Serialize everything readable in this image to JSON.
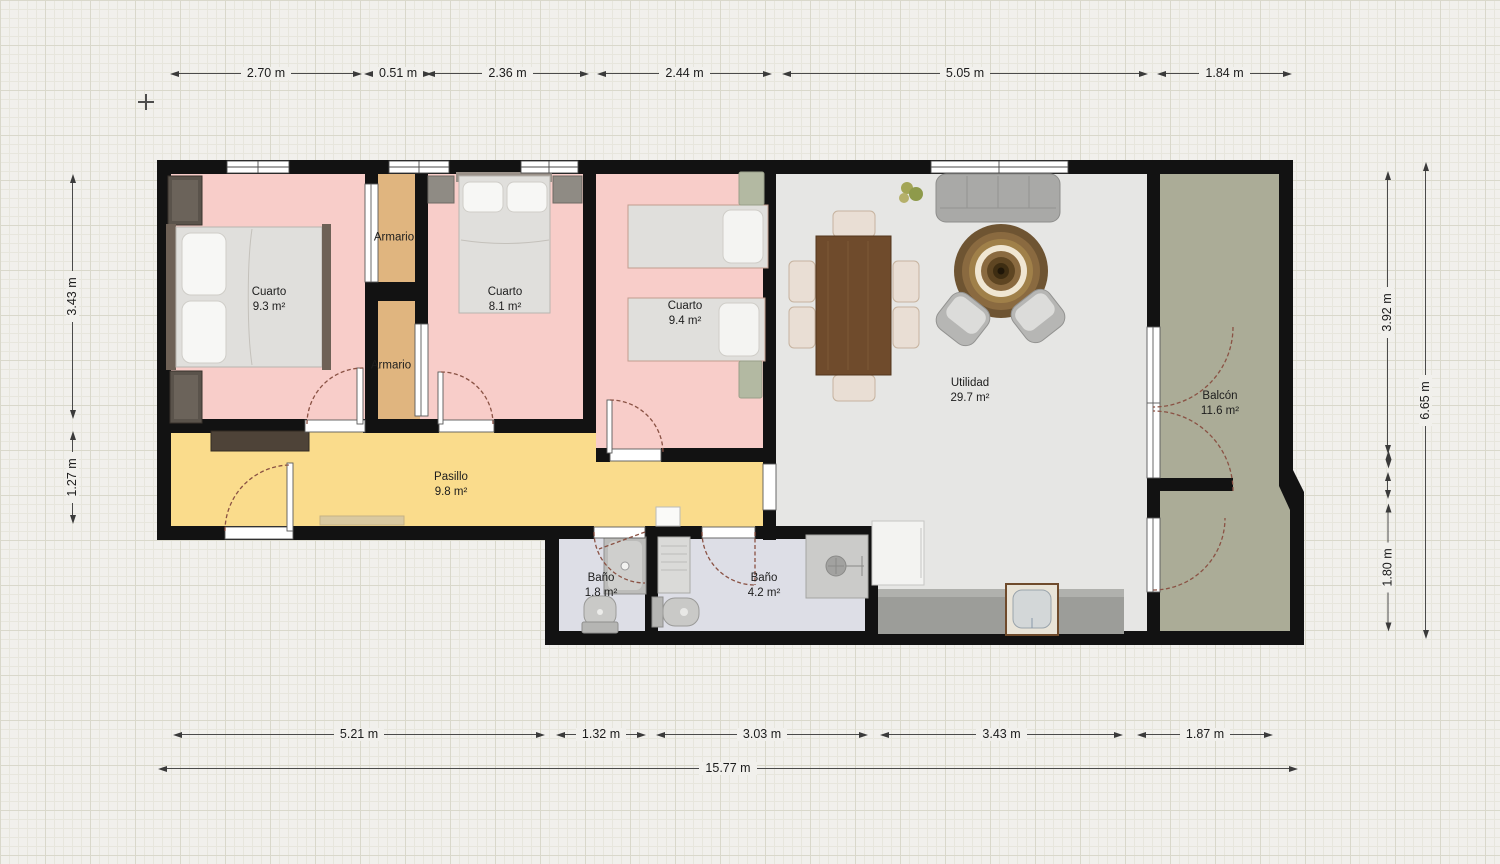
{
  "rooms": {
    "cuarto1": {
      "name": "Cuarto",
      "area": "9.3 m²",
      "color": "#f8cdc9"
    },
    "cuarto2": {
      "name": "Cuarto",
      "area": "8.1 m²",
      "color": "#f8cdc9"
    },
    "cuarto3": {
      "name": "Cuarto",
      "area": "9.4 m²",
      "color": "#f8cdc9"
    },
    "armario1": {
      "name": "Armario",
      "color": "#e0b57f"
    },
    "armario2": {
      "name": "Armario",
      "color": "#e0b57f"
    },
    "pasillo": {
      "name": "Pasillo",
      "area": "9.8 m²",
      "color": "#fadc8c"
    },
    "bano1": {
      "name": "Baño",
      "area": "1.8 m²",
      "color": "#dddee6"
    },
    "bano2": {
      "name": "Baño",
      "area": "4.2 m²",
      "color": "#dddee6"
    },
    "utilidad": {
      "name": "Utilidad",
      "area": "29.7 m²",
      "color": "#e6e6e4"
    },
    "balcon": {
      "name": "Balcón",
      "area": "11.6 m²",
      "color": "#abac97"
    }
  },
  "dimensions": {
    "top": [
      "2.70 m",
      "0.51 m",
      "2.36 m",
      "2.44 m",
      "5.05 m",
      "1.84 m"
    ],
    "left": [
      "3.43 m",
      "1.27 m"
    ],
    "right": [
      "3.92 m",
      "1.80 m"
    ],
    "right_overall": "6.65 m",
    "bottom": [
      "5.21 m",
      "1.32 m",
      "3.03 m",
      "3.43 m",
      "1.87 m"
    ],
    "bottom_overall": "15.77 m"
  },
  "colors": {
    "wall": "#121212",
    "background": "#f1f0ec",
    "dimension_line": "#3a3a3a",
    "door_arc": "#8a5244",
    "kitchen_counter": "#9c9d99"
  }
}
